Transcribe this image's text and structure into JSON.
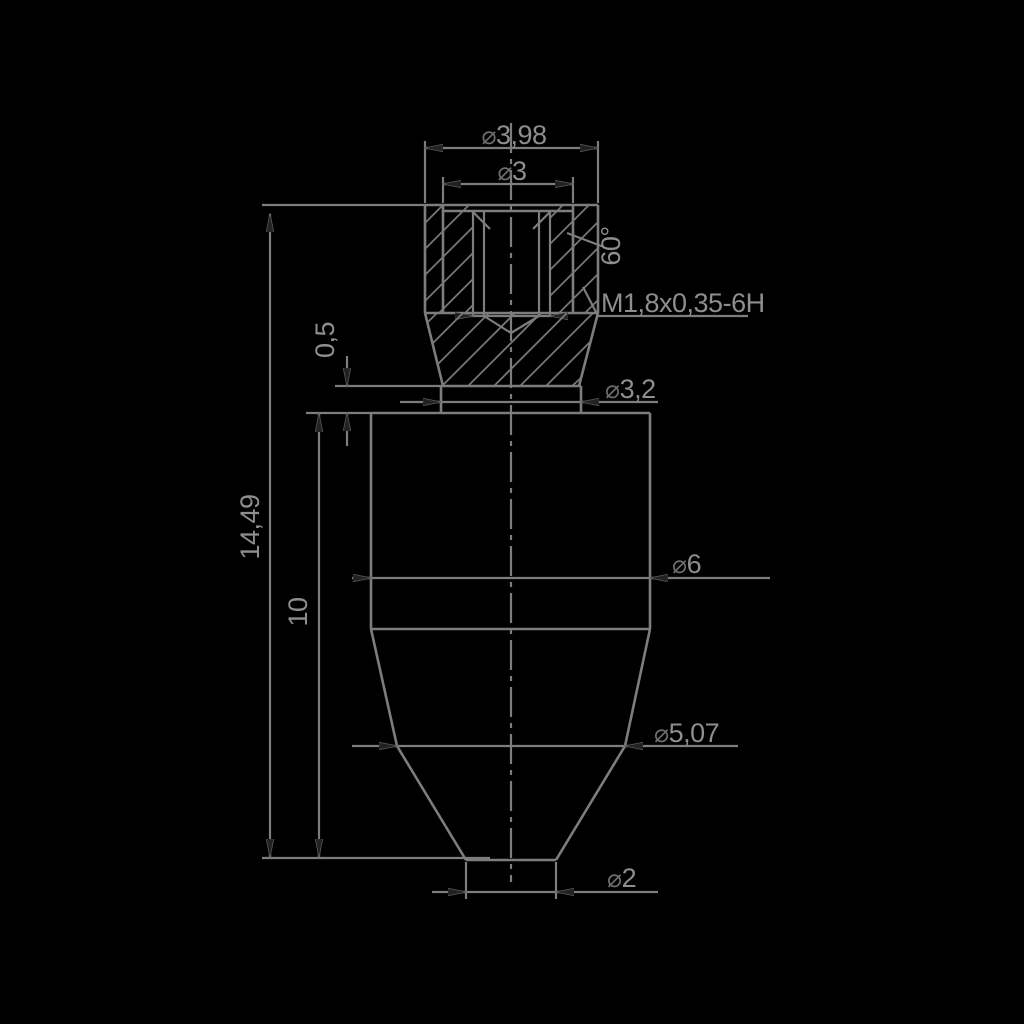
{
  "meta": {
    "type": "technical-drawing-section-view",
    "background": "#000000",
    "line_color": "#7d7d7d",
    "text_color": "#8e8e8e",
    "arrow_color": "#222222"
  },
  "dimensions": {
    "top_diameter": {
      "prefix": "⌀",
      "value": "3,98"
    },
    "inner_diameter": {
      "prefix": "⌀",
      "value": "3"
    },
    "chamfer_angle": {
      "value": "60°"
    },
    "thread_spec": {
      "value": "M1,8x0,35-6H"
    },
    "step_height": {
      "value": "0,5"
    },
    "collar_diameter": {
      "prefix": "⌀",
      "value": "3,2"
    },
    "overall_length": {
      "value": "14,49"
    },
    "body_length": {
      "value": "10"
    },
    "body_diameter": {
      "prefix": "⌀",
      "value": "6"
    },
    "shoulder_diameter": {
      "prefix": "⌀",
      "value": "5,07"
    },
    "tip_diameter": {
      "prefix": "⌀",
      "value": "2"
    }
  }
}
